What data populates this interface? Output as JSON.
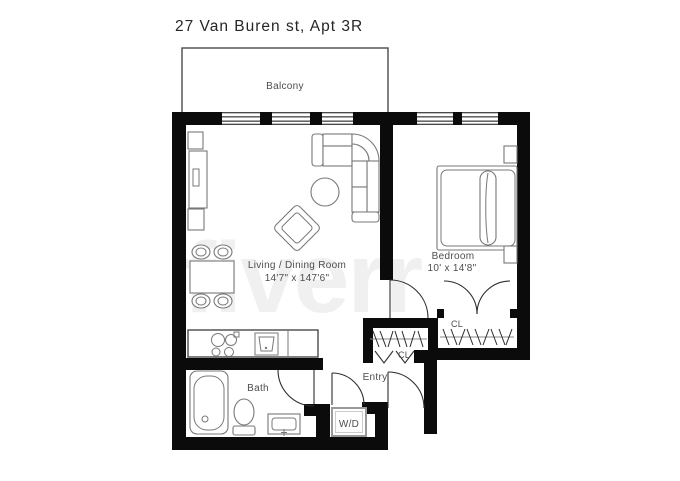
{
  "title": "27 Van Buren st, Apt 3R",
  "watermark": {
    "brand": "fiverr",
    "registered_mark": "®"
  },
  "rooms": {
    "balcony": {
      "label": "Balcony"
    },
    "living_dining": {
      "label": "Living / Dining Room",
      "dimensions": "14'7\" x 147'6\""
    },
    "bedroom": {
      "label": "Bedroom",
      "dimensions": "10' x 14'8\""
    },
    "bath": {
      "label": "Bath"
    },
    "entry": {
      "label": "Entry"
    },
    "laundry": {
      "label": "W/D"
    },
    "closet_hall": {
      "label": "CL"
    },
    "closet_bedroom": {
      "label": "CL"
    }
  },
  "colors": {
    "wall": "#0b0b0b",
    "furniture_line": "#787878",
    "label_text": "#4d4d4d",
    "background": "#ffffff"
  }
}
